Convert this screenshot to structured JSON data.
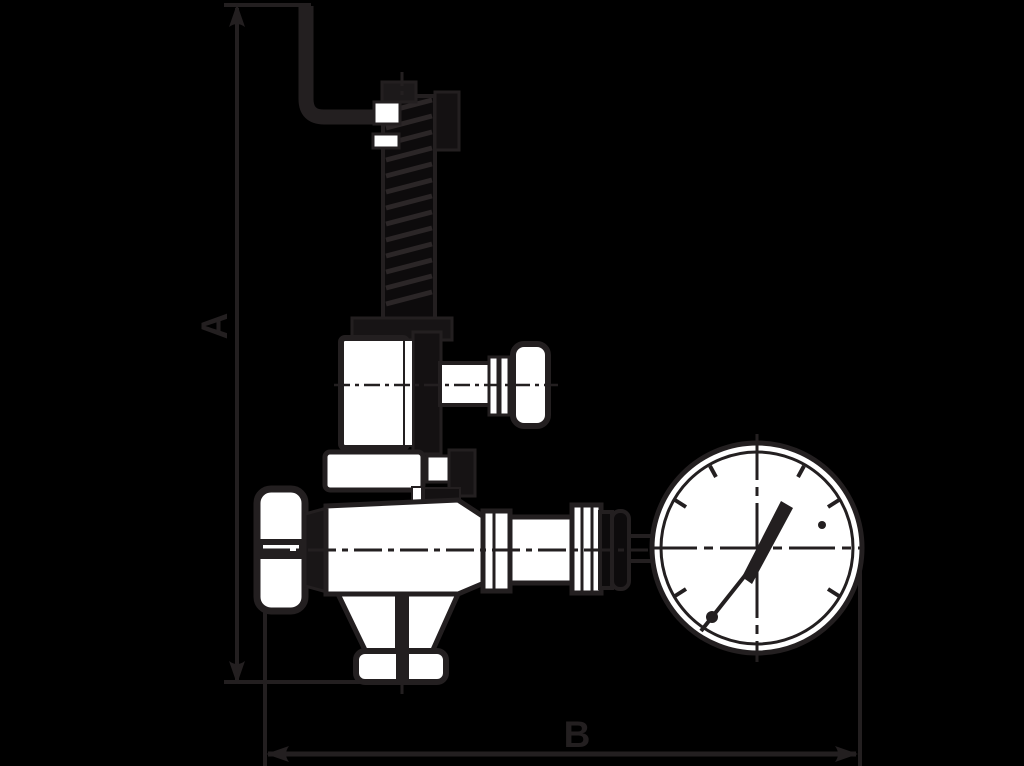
{
  "figure": {
    "type": "technical-dimension-drawing",
    "subject": "safety-valve-with-pressure-gauge"
  },
  "colors": {
    "background": "#000000",
    "ink": "#231f20",
    "paper": "#ffffff"
  },
  "dimensions": {
    "a": {
      "label": "A",
      "orientation": "vertical"
    },
    "b": {
      "label": "B",
      "orientation": "horizontal"
    }
  }
}
